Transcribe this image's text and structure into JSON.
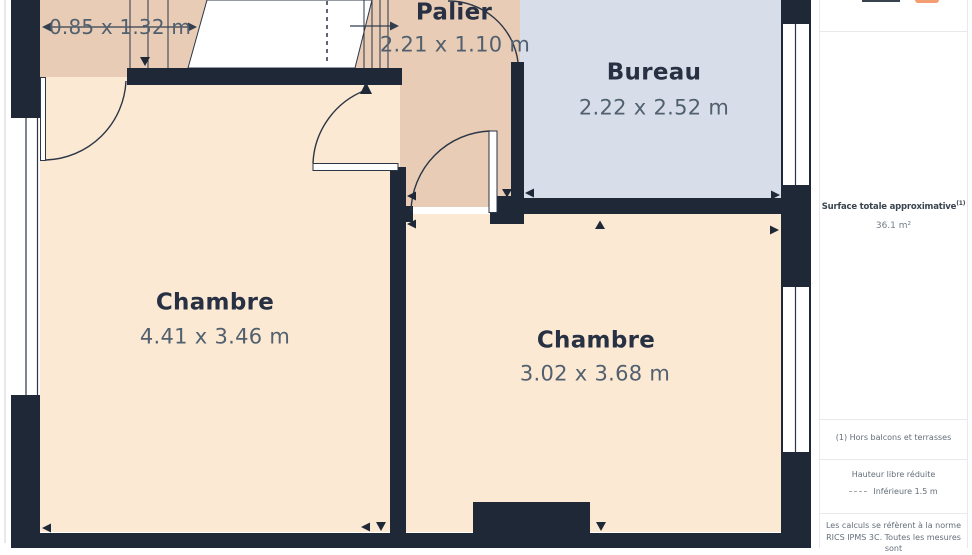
{
  "plan": {
    "rooms": [
      {
        "name": "Palier",
        "dims": "2.21 x 1.10 m"
      },
      {
        "name": "Bureau",
        "dims": "2.22 x 2.52 m"
      },
      {
        "name": "Chambre",
        "dims": "4.41 x 3.46 m"
      },
      {
        "name": "Chambre",
        "dims": "3.02 x 3.68 m"
      }
    ],
    "stair_dims": "0.85 x 1.32 m",
    "colors": {
      "wall": "#1e2836",
      "room_fill": "#fce9d3",
      "hall_fill": "#e9ccb5",
      "office_fill": "#d8dee9"
    }
  },
  "sidebar": {
    "accent_color": "#f29d72",
    "total_area_label": "Surface totale approximative",
    "total_area_note_mark": "(1)",
    "total_area_value": "36.1 m²",
    "footnote": "(1) Hors balcons et terrasses",
    "legend_title": "Hauteur libre réduite",
    "legend_item_label": "Inférieure 1.5 m",
    "disclaimer": "Les calculs se réfèrent à la norme RICS IPMS 3C. Toutes les mesures sont"
  }
}
